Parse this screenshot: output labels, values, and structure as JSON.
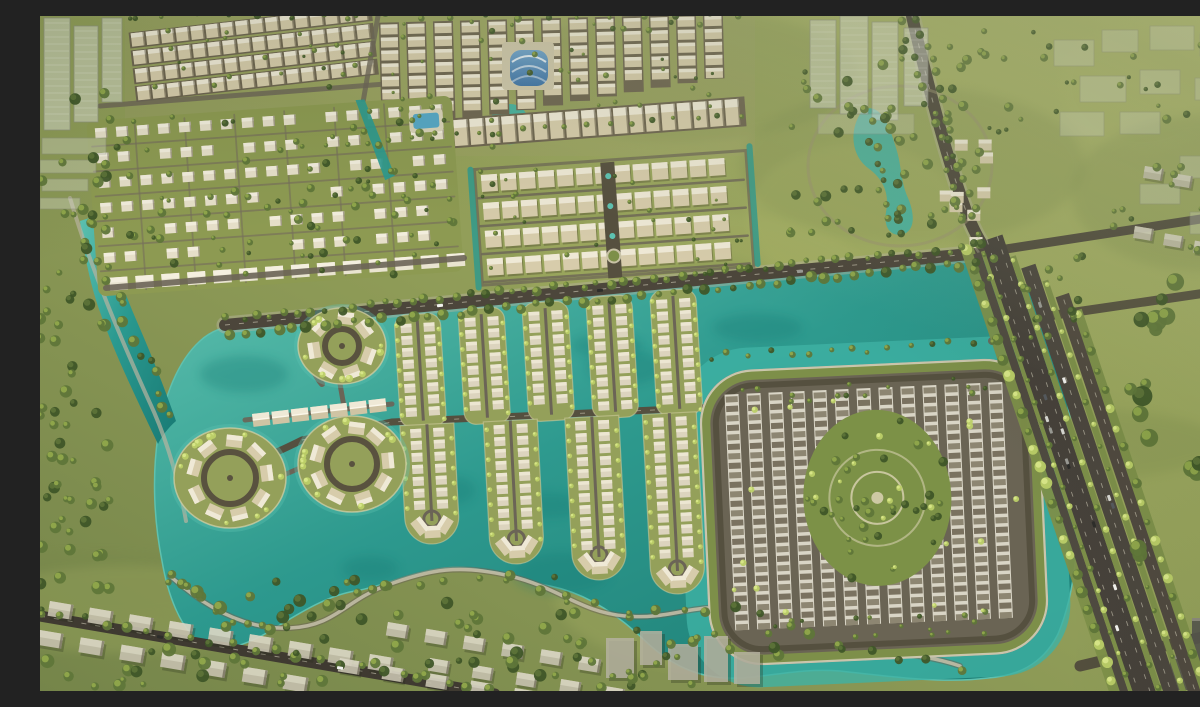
{
  "meta": {
    "title": "Lakeside township aerial render",
    "type": "aerial-architectural-render",
    "time_of_day": "late afternoon sunlight",
    "description": "Aerial rendering of a lakeside master-planned residential township with a turquoise lagoon and canal network, circular villa islands, finger strips of waterfront villas, a rounded rowhouse precinct with an oval central park, dense townhouse grids, ghosted unbuilt towers and wide tree-lined boulevards."
  },
  "palette": {
    "terrain": "#94a05a",
    "terrain_light": "#b0ba6b",
    "terrain_dark": "#75854a",
    "canopy": "#5f7639",
    "canopy_dark": "#3f5628",
    "canopy_light": "#96ad4e",
    "palm": "#bccf68",
    "water": "#2b9a90",
    "water_deep": "#187a74",
    "water_light": "#5ec3b2",
    "water_bright": "#3fb2a4",
    "building": "#d7ccab",
    "roof_light": "#efe9d6",
    "roof_mid": "#cfc4a4",
    "building_shadow": "#6e6550",
    "rowhouse": "#d9d5c6",
    "rowhouse_roof": "#7a7260",
    "cell": "#dcd4be",
    "cell_roof": "#ece6d2",
    "road": "#4c463b",
    "road_minor": "#6b6456",
    "road_light": "#b9b3a0",
    "lane_line": "#ddd7c3",
    "block_pavement": "#6a6454",
    "verge_green": "#7d8f49",
    "ghost": "#e4e5dd",
    "ghost_shadow": "#8e8f85",
    "ghost_dark": "#55544c",
    "pool_blue": "#56a7c6",
    "hall_blue": "#3f74a8",
    "shore": "#d8d2a8"
  },
  "regions": {
    "terrain": "Sunlit green terrain of a lakeside master-planned township",
    "central_lake": "Turquoise central lagoon and canal network",
    "villa_islands": "Circular villa islands with radial lots and loop drives",
    "canal_strips": "Finger strips and peninsulas of waterfront villas between canals",
    "rowhouse_block": "Rounded square precinct of terraced rowhouses ringed by a canal",
    "central_park": "Oval landscaped park at the center of the rowhouse precinct",
    "shophouse_grids": "Dense grids of low-rise shophouse and townhouse rows",
    "villa_grid": "Tree-lined grid of detached villas with clubhouse pool",
    "amenity_hall": "Blue barrel-roofed sports hall amenity",
    "amenity_pond": "Curved landscaped pond in the northeast neighborhood",
    "highrise_cluster": "Translucent unbuilt high-rise towers",
    "corner_towers": "Ghosted tower blocks at the top-left corner",
    "boulevard": "Wide arterial boulevard with tree-planted medians and traffic",
    "avenue": "Tree-lined avenue separating the townhouse grids from the lagoon",
    "shoreline": "Winding lakeside path through the southern green belt",
    "unbuilt_context": "Gray unbuilt context housing and future phases",
    "vehicles": "Cars travelling on the boulevard and avenue",
    "lighting": "Warm late-afternoon sunlight falling from the upper right"
  }
}
